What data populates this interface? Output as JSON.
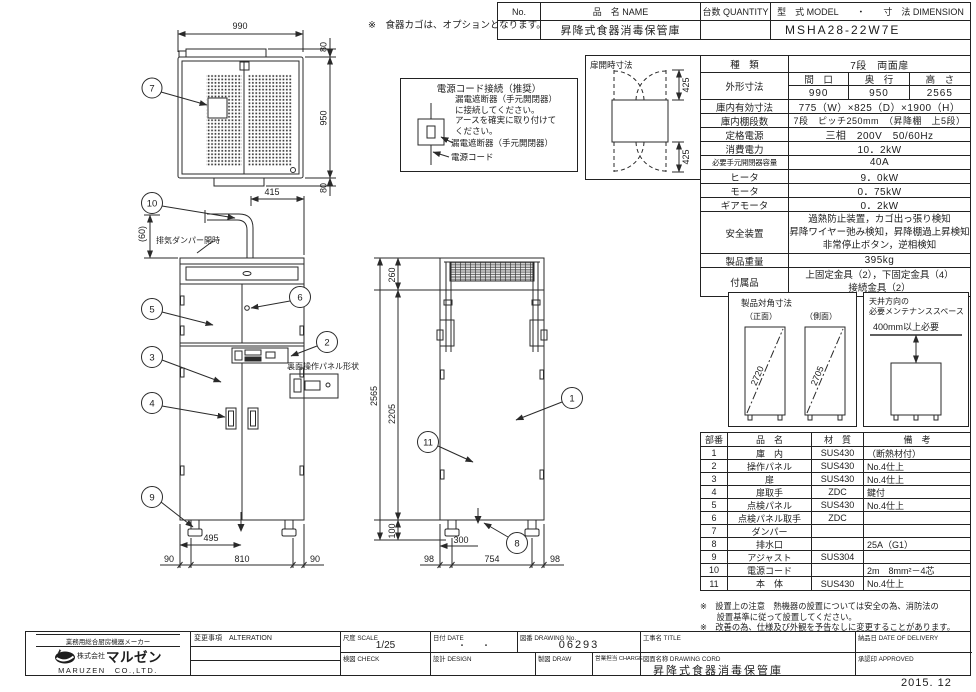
{
  "header_table": {
    "no_label": "No.",
    "name_label": "品　名 NAME",
    "qty_label": "台数 QUANTITY",
    "model_label": "型　式 MODEL　　・　　寸　法 DIMENSION",
    "name_value": "昇降式食器消毒保管庫",
    "model_value": "MSHA28-22W7E"
  },
  "option_note": "※　食器カゴは、オプションとなります。",
  "power_box": {
    "title": "電源コード接続（推奨）",
    "line1": "漏電遮断器（手元開閉器）",
    "line2": "に接続してください。",
    "line3": "アースを確実に取り付けて",
    "line4": "ください。",
    "breaker_label": "漏電遮断器（手元開閉器）",
    "cord_label": "電源コード"
  },
  "door_open_box": {
    "title": "扉開時寸法",
    "dim_top": "425",
    "dim_bottom": "425"
  },
  "spec_table": {
    "kind_label": "種　類",
    "kind_value": "7段　両面扉",
    "dims_label": "外形寸法",
    "dims_headers": [
      "間　口",
      "奥　行",
      "高　さ"
    ],
    "dims_values": [
      "990",
      "950",
      "2565"
    ],
    "rows": [
      {
        "label": "庫内有効寸法",
        "value": "775（W）×825（D）×1900（H）"
      },
      {
        "label": "庫内棚段数",
        "value": "7段　ピッチ250mm　（昇降棚　上5段）"
      },
      {
        "label": "定格電源",
        "value": "三相　200V　50/60Hz"
      },
      {
        "label": "消費電力",
        "value": "10．2kW"
      },
      {
        "label": "必要手元開閉器容量",
        "value": "40A"
      },
      {
        "label": "ヒータ",
        "value": "9．0kW"
      },
      {
        "label": "モータ",
        "value": "0．75kW"
      },
      {
        "label": "ギアモータ",
        "value": "0．2kW"
      }
    ],
    "safety_label": "安全装置",
    "safety_lines": [
      "過熱防止装置，カゴ出っ張り検知",
      "昇降ワイヤー弛み検知，昇降棚過上昇検知",
      "非常停止ボタン，逆相検知"
    ],
    "weight_label": "製品重量",
    "weight_value": "395kg",
    "acc_label": "付属品",
    "acc_lines": [
      "上固定金具（2），下固定金具（4）",
      "接続金具（2）"
    ]
  },
  "diagonal_box": {
    "title": "製品対角寸法",
    "front_label": "（正面）",
    "side_label": "（側面）",
    "front_value": "2720",
    "side_value": "2705"
  },
  "maintenance_box": {
    "title1": "天井方向の",
    "title2": "必要メンテナンススペース",
    "clearance": "400mm以上必要"
  },
  "parts_table": {
    "headers": [
      "部番",
      "品　名",
      "材　質",
      "備　考"
    ],
    "rows": [
      [
        "1",
        "庫　内",
        "SUS430",
        "（断熱材付）"
      ],
      [
        "2",
        "操作パネル",
        "SUS430",
        "No.4仕上"
      ],
      [
        "3",
        "扉",
        "SUS430",
        "No.4仕上"
      ],
      [
        "4",
        "扉取手",
        "ZDC",
        "鍵付"
      ],
      [
        "5",
        "点検パネル",
        "SUS430",
        "No.4仕上"
      ],
      [
        "6",
        "点検パネル取手",
        "ZDC",
        ""
      ],
      [
        "7",
        "ダンパー",
        "",
        ""
      ],
      [
        "8",
        "排水口",
        "",
        "25A（G1）"
      ],
      [
        "9",
        "アジャスト",
        "SUS304",
        ""
      ],
      [
        "10",
        "電源コード",
        "",
        "2m　8mm²－4芯"
      ],
      [
        "11",
        "本　体",
        "SUS430",
        "No.4仕上"
      ]
    ]
  },
  "notes": {
    "line1": "※　設置上の注意　熱機器の設置については安全の為、消防法の",
    "line2": "　　設置基準に従って設置してください。",
    "line3": "※　改善の為、仕様及び外観を予告なしに変更することがあります。"
  },
  "title_block": {
    "maker_tagline": "業務用総合厨房機器メーカー",
    "company_prefix": "株式会社",
    "company_name": "マルゼン",
    "company_en": "MARUZEN　CO.,LTD.",
    "alteration_label": "変更事項　ALTERATION",
    "scale_label": "尺度 SCALE",
    "scale_value": "1/25",
    "date_label": "日付 DATE",
    "date_value": "・　　・",
    "drawing_no_label": "図番 DRAWING No.",
    "drawing_no_value": "06293",
    "title_label": "工事名 TITLE",
    "delivery_label": "納品日 DATE OF DELIVERY",
    "check_label": "検図 CHECK",
    "design_label": "設計 DESIGN",
    "draw_label": "製図 DRAW",
    "charge_label": "営業担当 CHARGE",
    "drawing_name_label": "図面名称 DRAWING CORD",
    "drawing_name_value": "昇降式食器消毒保管庫",
    "approved_label": "承認印 APPROVED",
    "date_stamp": "2015. 12"
  },
  "drawing": {
    "plan": {
      "width": "990",
      "depth": "950",
      "top_offset": "80",
      "bottom_offset": "80"
    },
    "front": {
      "pipe_offset": "415",
      "damper_gap": "(60)",
      "damper_note": "排気ダンパー開時",
      "panel_note": "裏面操作パネル形状",
      "drain_offset": "495",
      "left_margin": "90",
      "leg_span": "810",
      "right_margin": "90"
    },
    "side": {
      "top_section": "260",
      "total_height": "2565",
      "mid_height": "2205",
      "leg_height": "100",
      "drain_offset": "300",
      "left_margin": "98",
      "leg_span": "754",
      "right_margin": "98"
    },
    "callouts": {
      "n1": "1",
      "n2": "2",
      "n3": "3",
      "n4": "4",
      "n5": "5",
      "n6": "6",
      "n7": "7",
      "n8": "8",
      "n9": "9",
      "n10": "10",
      "n11": "11"
    }
  }
}
